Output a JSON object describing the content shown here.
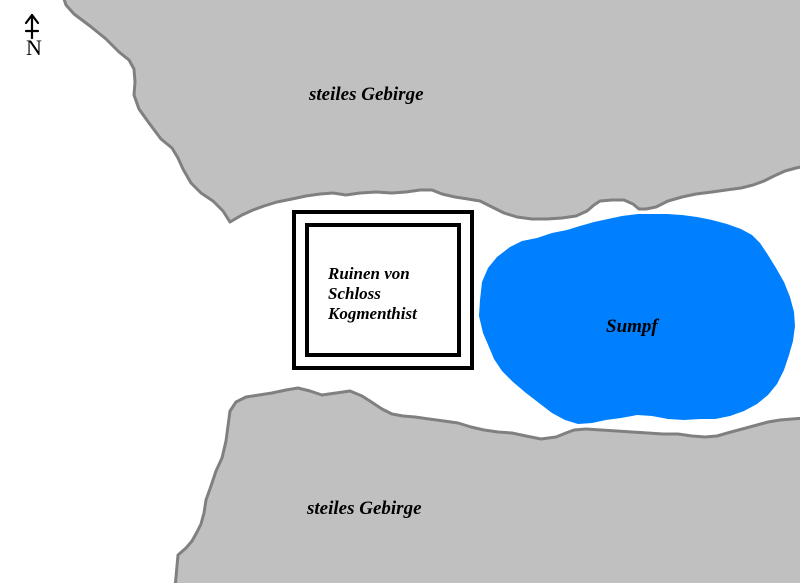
{
  "map": {
    "title": "fantasy sketch map",
    "background_color": "#ffffff",
    "compass": {
      "label": "N",
      "icon": "north-arrow-icon",
      "color": "#000000"
    },
    "regions": {
      "mountain_north": {
        "label": "steiles Gebirge",
        "fill": "#c0c0c0",
        "stroke": "#808080"
      },
      "mountain_south": {
        "label": "steiles Gebirge",
        "fill": "#c0c0c0",
        "stroke": "#808080"
      },
      "swamp": {
        "label": "Sumpf",
        "fill": "#0080ff"
      },
      "ruins": {
        "label": "Ruinen von Schloss Kogmenthist",
        "label_lines": [
          "Ruinen von",
          "Schloss",
          "Kogmenthist"
        ],
        "border_color": "#000000"
      }
    }
  }
}
